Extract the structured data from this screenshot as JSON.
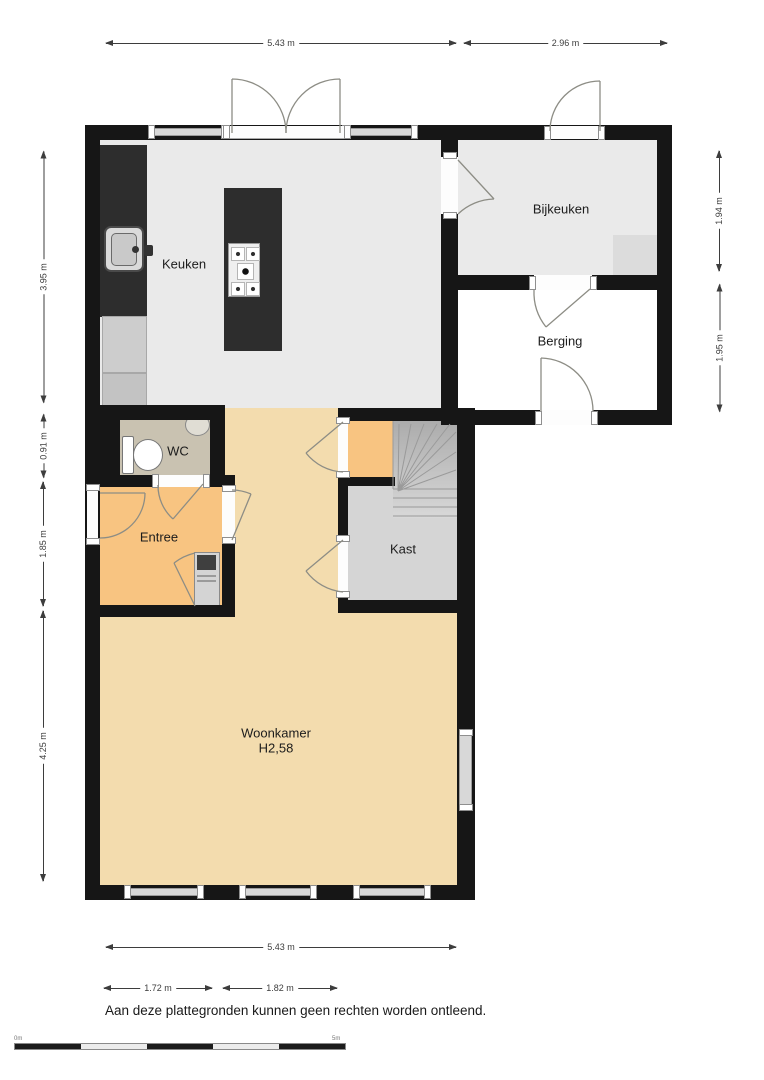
{
  "disclaimer": "Aan deze plattegronden kunnen geen rechten worden ontleend.",
  "rooms": {
    "keuken": {
      "label": "Keuken"
    },
    "bijkeuken": {
      "label": "Bijkeuken"
    },
    "berging": {
      "label": "Berging"
    },
    "wc": {
      "label": "WC"
    },
    "entree": {
      "label": "Entree"
    },
    "kast": {
      "label": "Kast"
    },
    "woonkamer": {
      "label": "Woonkamer",
      "height": "H2,58"
    }
  },
  "dimensions": {
    "top_width_main": "5.43 m",
    "top_width_wing": "2.96 m",
    "left_keuken": "3.95 m",
    "left_wc": "0.91 m",
    "left_entree": "1.85 m",
    "left_woonkamer": "4.25 m",
    "right_bijkeuken": "1.94 m",
    "right_berging": "1.95 m",
    "bottom_width": "5.43 m",
    "bottom_entree": "1.72 m",
    "bottom_hall": "1.82 m"
  },
  "scale_bar": {
    "start": "0m",
    "end": "5m"
  },
  "colors": {
    "wall": "#161616",
    "floor-gray": "#eaeaea",
    "floor-white": "#ffffff",
    "floor-tan": "#f3dcae",
    "floor-orange": "#f8c481",
    "floor-wc": "#c9c2b1",
    "floor-kast": "#d5d5d5",
    "counter": "#2d2d2d",
    "door": "#8d8d85",
    "window": "#d8d8d8",
    "dim": "#3d3d3d"
  }
}
